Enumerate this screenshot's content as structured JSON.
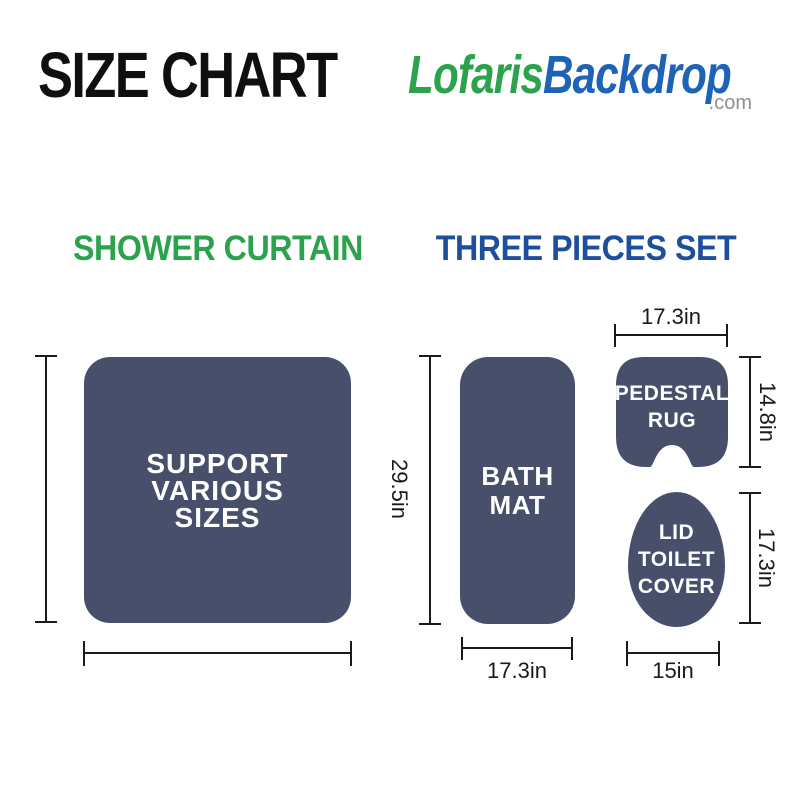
{
  "header": {
    "title": "SIZE CHART",
    "logo": {
      "green_text": "Lofaris",
      "blue_text": "Backdrop",
      "domain": ".com"
    }
  },
  "colors": {
    "shape_fill": "#474F6B",
    "heading_green": "#2BA34D",
    "heading_blue": "#1D4F9E",
    "logo_green": "#2BA34D",
    "logo_blue": "#1E63B5",
    "domain_gray": "#8E8E8E",
    "measure_line": "#1A1A1A",
    "shape_text": "#FFFFFF"
  },
  "shower_curtain": {
    "heading": "SHOWER CURTAIN",
    "label_lines": [
      "SUPPORT",
      "VARIOUS",
      "SIZES"
    ]
  },
  "three_pieces_set": {
    "heading": "THREE PIECES SET",
    "bath_mat": {
      "label_lines": [
        "BATH",
        "MAT"
      ],
      "height_label": "29.5in",
      "width_label": "17.3in"
    },
    "pedestal_rug": {
      "label_lines": [
        "PEDESTAL",
        "RUG"
      ],
      "width_label": "17.3in",
      "height_label": "14.8in"
    },
    "lid_toilet_cover": {
      "label_lines": [
        "LID",
        "TOILET",
        "COVER"
      ],
      "height_label": "17.3in",
      "width_label": "15in"
    }
  }
}
